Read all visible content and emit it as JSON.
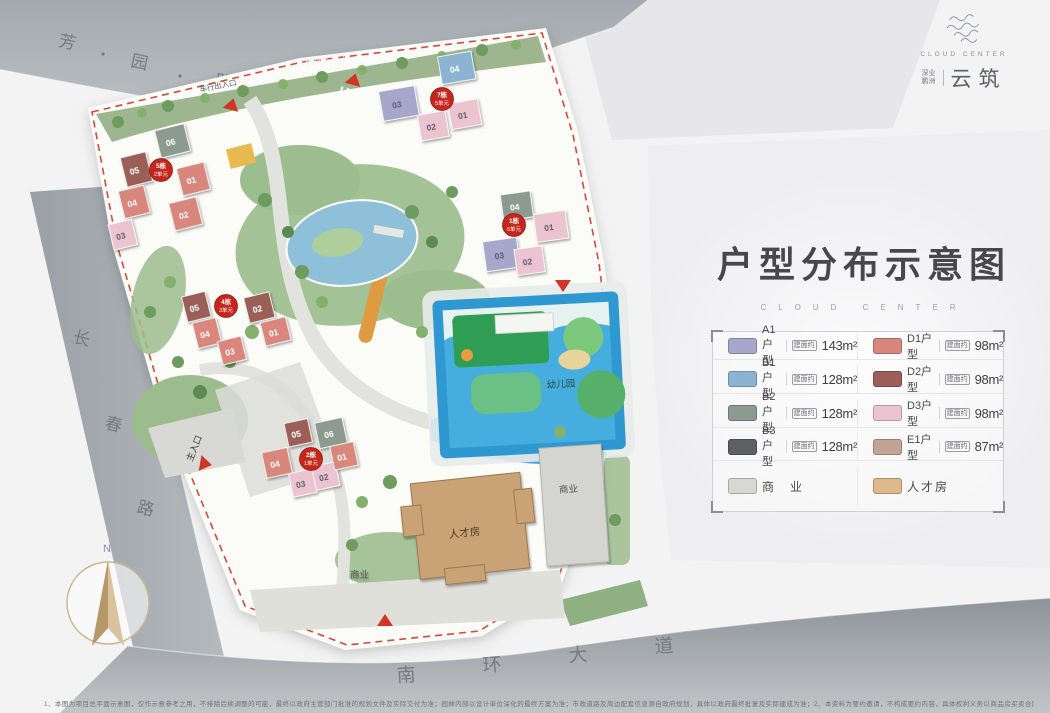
{
  "header": {
    "title": "户型分布示意图",
    "subtitle": "CLOUD CENTER"
  },
  "logo": {
    "en": "CLOUD CENTER",
    "cn_small_top": "深业",
    "cn_small_bottom": "鹏洲",
    "cn_main": "云筑"
  },
  "roads": {
    "top": [
      "芳",
      "园",
      "路"
    ],
    "left": [
      "长",
      "春",
      "路"
    ],
    "bottom": [
      "南",
      "环",
      "大",
      "道"
    ]
  },
  "compass": {
    "north": "N"
  },
  "site_labels": {
    "kindergarten": "幼儿园",
    "talent_house": "人才房",
    "commerce_a": "商业",
    "commerce_b": "商业",
    "main_entrance": "主入口",
    "pedestrian_entrance": "步行出入口",
    "vehicle_entrance": "车行出入口"
  },
  "badges": [
    {
      "line1": "7栋",
      "line2": "5单元"
    },
    {
      "line1": "5栋",
      "line2": "2单元"
    },
    {
      "line1": "1栋",
      "line2": "6单元"
    },
    {
      "line1": "4栋",
      "line2": "3单元"
    },
    {
      "line1": "2栋",
      "line2": "1单元"
    }
  ],
  "buildings": {
    "tc": [
      "03",
      "04",
      "01",
      "02"
    ],
    "tl": [
      "06",
      "05",
      "04",
      "03",
      "01",
      "02"
    ],
    "rm": [
      "04",
      "03",
      "01",
      "02"
    ],
    "lm": [
      "05",
      "04",
      "03",
      "02",
      "01"
    ],
    "bt": [
      "06",
      "05",
      "04",
      "03",
      "02",
      "01"
    ]
  },
  "legend": {
    "left": [
      {
        "type": "A1户型",
        "prefix": "建面约",
        "area": "143m²",
        "color": "#a7a6cb"
      },
      {
        "type": "B1户型",
        "prefix": "建面约",
        "area": "128m²",
        "color": "#8cb4d2"
      },
      {
        "type": "B2户型",
        "prefix": "建面约",
        "area": "128m²",
        "color": "#8c9b90"
      },
      {
        "type": "B3户型",
        "prefix": "建面约",
        "area": "128m²",
        "color": "#5f6063"
      }
    ],
    "right": [
      {
        "type": "D1户型",
        "prefix": "建面约",
        "area": "98m²",
        "color": "#d9877c"
      },
      {
        "type": "D2户型",
        "prefix": "建面约",
        "area": "98m²",
        "color": "#9b5f58"
      },
      {
        "type": "D3户型",
        "prefix": "建面约",
        "area": "98m²",
        "color": "#ecc3d1"
      },
      {
        "type": "E1户型",
        "prefix": "建面约",
        "area": "87m²",
        "color": "#c2a396"
      }
    ],
    "extra": [
      {
        "label": "商　业",
        "color": "#d7d8d2"
      },
      {
        "label": "人才房",
        "color": "#dfb98c"
      }
    ]
  },
  "accent_colors": {
    "boundary_red": "#cf3a2c",
    "badge_red": "#c6261b",
    "road_gray": "#a6acb1",
    "pool_blue": "#2f98d0"
  },
  "footer": {
    "disclaimer": "1、本图为项目总平面示意图，仅作示意参考之用，不排除后续调整的可能，最终以政府主管部门批准的规划文件及实际交付为准；园林内部以设计单位深化的最终方案为准；市政道路及周边配套信息源自政府规划，具体以政府最终批复及实际建成为准；2、本资料为要约邀请，不构成要约内容，具体权利义务以商品房买卖合同及附件等协议为准；3、本资料制作时间为2022年01月。"
  }
}
